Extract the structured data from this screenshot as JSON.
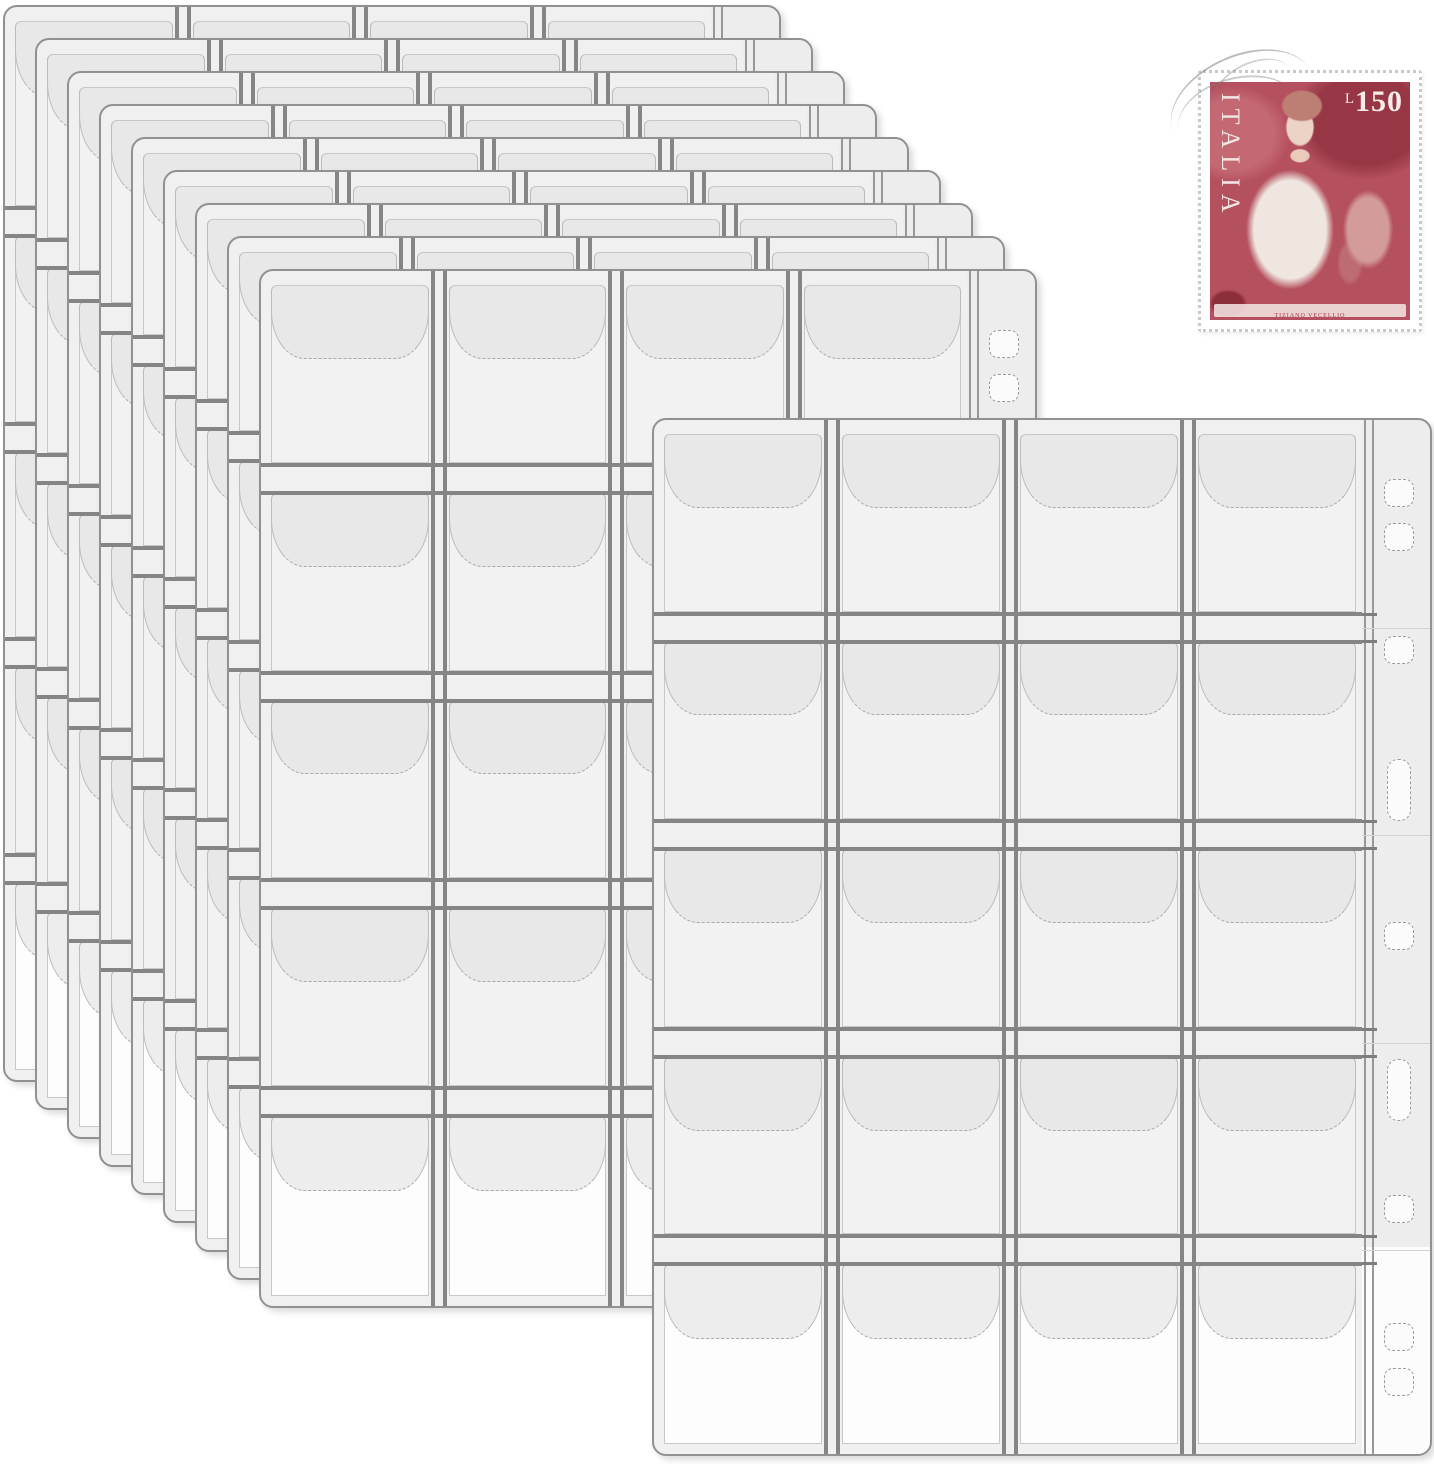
{
  "scene": {
    "description": "Stack of clear plastic 20-pocket coin collection binder pages with an Italian postage stamp",
    "background": "#ffffff"
  },
  "product": {
    "name": "20-pocket coin collection page",
    "pages_total": 10,
    "stacked_pages": 9,
    "grid": {
      "columns": 4,
      "rows": 5,
      "pockets_per_page": 20
    },
    "colors": {
      "page_bg": "#f0f0f0",
      "cell_body": "#f2f2f2",
      "bottom_row_body": "#fdfdfd",
      "flap": "#e8e8e8",
      "bottom_row_flap": "#ededed",
      "weld_line": "#858585",
      "page_border": "#919191",
      "pocket_line": "#c8c8c8",
      "strip_bg": "#ededed",
      "strip_line": "#989898",
      "hole_fill": "#fbfbfb"
    },
    "binder_holes": {
      "count": 9,
      "items": [
        {
          "type": "round",
          "frac": 0.07
        },
        {
          "type": "round",
          "frac": 0.113
        },
        {
          "type": "round",
          "frac": 0.222
        },
        {
          "type": "slot",
          "frac": 0.356
        },
        {
          "type": "round",
          "frac": 0.497
        },
        {
          "type": "slot",
          "frac": 0.645
        },
        {
          "type": "round",
          "frac": 0.76
        },
        {
          "type": "round",
          "frac": 0.883
        },
        {
          "type": "round",
          "frac": 0.927
        }
      ]
    },
    "layout": {
      "stack_origin": {
        "x": 3,
        "y": 5
      },
      "stack_offset": {
        "x": 32,
        "y": 33
      },
      "stack_page": {
        "width": 778,
        "height_start": 1077,
        "height_step": 4.75
      },
      "front_page": {
        "x": 652,
        "y": 418,
        "width": 780,
        "height": 1038
      },
      "strip_width": 68
    }
  },
  "stamp": {
    "country": "ITALIA",
    "currency_letter": "L",
    "value": "150",
    "caption": "TIZIANO VECELLIO",
    "colors": {
      "panel": "#b5505f",
      "text": "#f5ece8",
      "paper": "#ffffff"
    }
  }
}
